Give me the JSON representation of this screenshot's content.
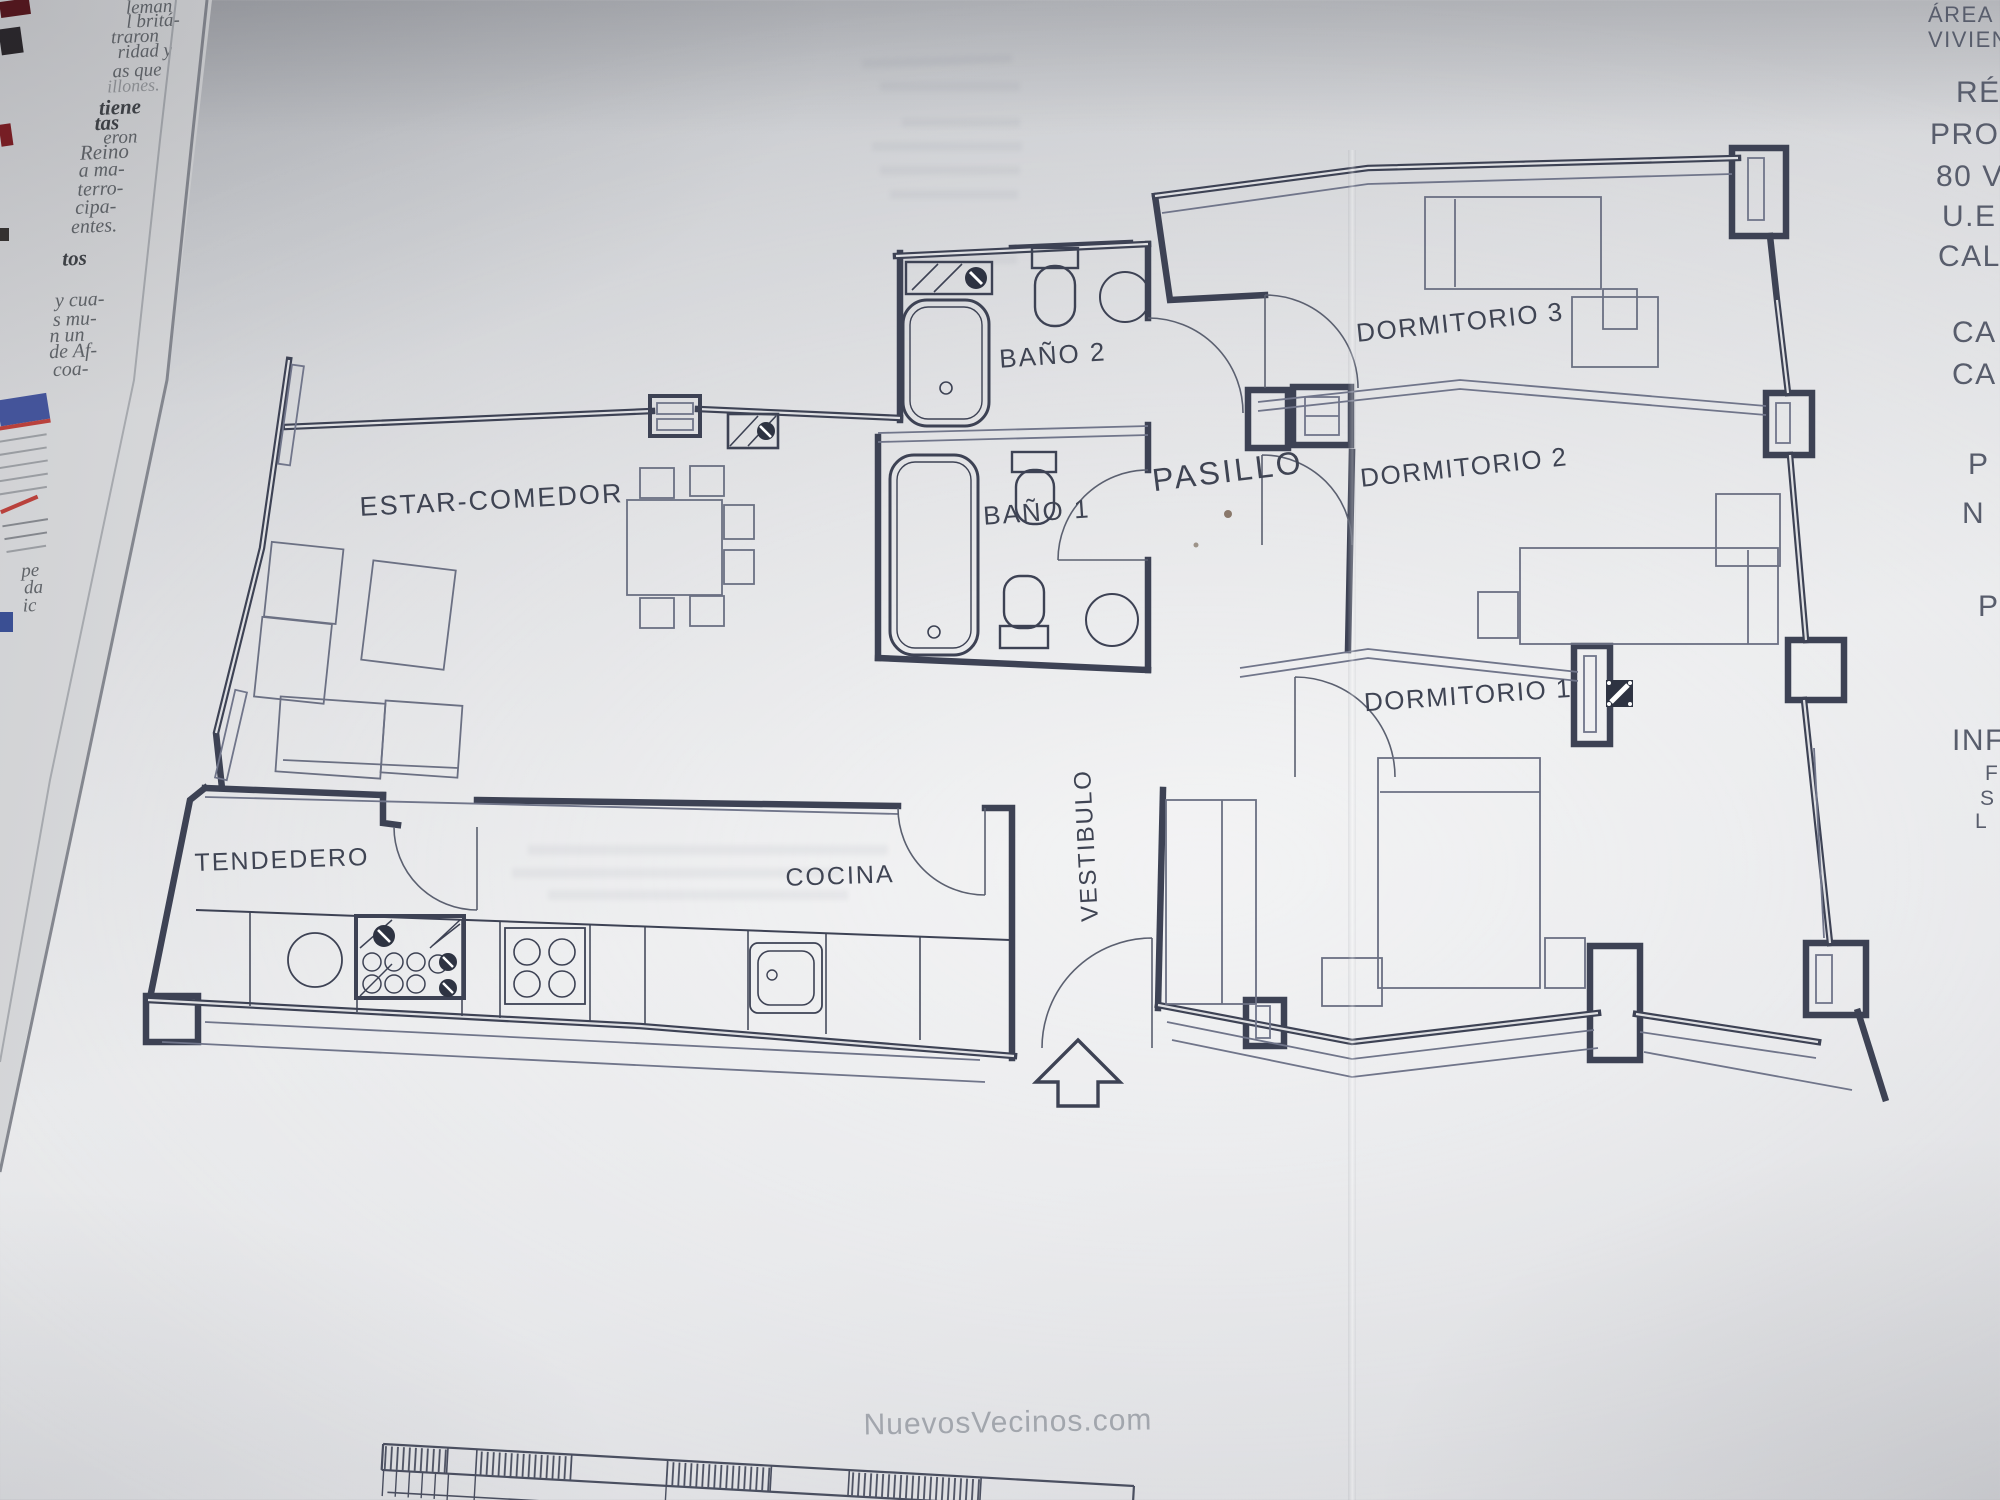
{
  "floorplan": {
    "labels": {
      "estar": "ESTAR-COMEDOR",
      "bano2": "BAÑO 2",
      "bano1": "BAÑO 1",
      "pasillo": "PASILLO",
      "dormitorio3": "DORMITORIO 3",
      "dormitorio2": "DORMITORIO 2",
      "dormitorio1": "DORMITORIO 1",
      "tendedero": "TENDEDERO",
      "cocina": "COCINA",
      "vestibulo": "VESTIBULO"
    },
    "ink_color": "#3d4254",
    "thin_color": "#70758a"
  },
  "margin_right": {
    "lines": [
      {
        "text": "ÁREA D"
      },
      {
        "text": "VIVIEN"
      },
      {
        "text": "RÉGI"
      },
      {
        "text": "PRO"
      },
      {
        "text": "80 V"
      },
      {
        "text": "U.E"
      },
      {
        "text": "CAL"
      },
      {
        "text": "CA"
      },
      {
        "text": "CA"
      },
      {
        "text": "P"
      },
      {
        "text": "N"
      },
      {
        "text": "P"
      },
      {
        "text": "INF"
      },
      {
        "text": "F"
      },
      {
        "text": "S"
      },
      {
        "text": "L"
      }
    ]
  },
  "newspaper": {
    "fragments": [
      "leman",
      "l britá-",
      "traron",
      "ridad y",
      "as que",
      "illones.",
      "eron",
      "Reino",
      "a ma-",
      "terro-",
      "cipa-",
      "entes.",
      "y cua-",
      "s mu-",
      "n un",
      "de Af-",
      "coa-",
      "pe",
      "da",
      "ic"
    ],
    "bold_fragments": [
      "tiene",
      "tas",
      "tos"
    ],
    "chart_blue": "#44549a",
    "chart_red": "#b9413c"
  },
  "watermark": {
    "text": "NuevosVecinos.com"
  }
}
